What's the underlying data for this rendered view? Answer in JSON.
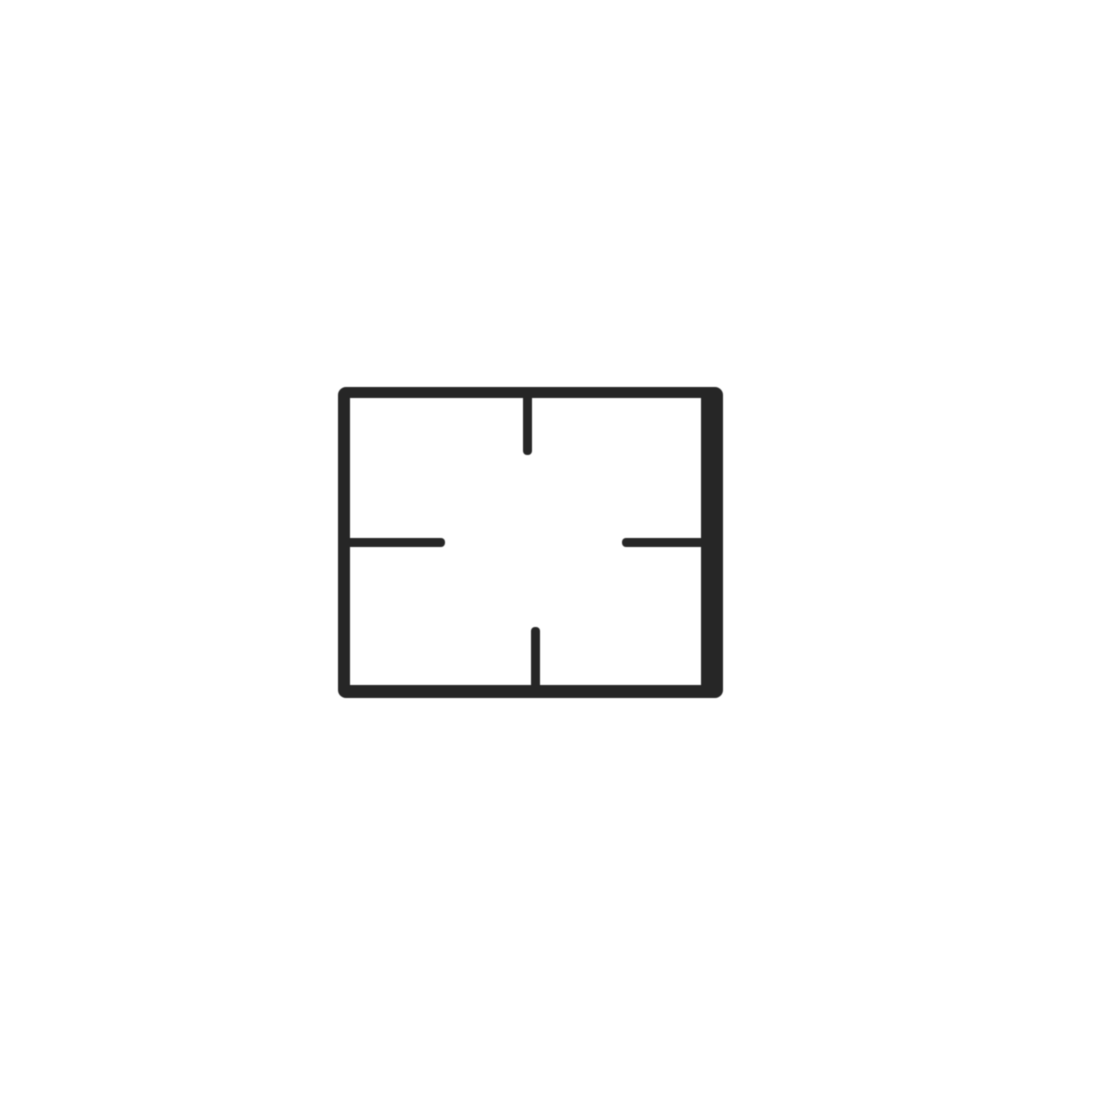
{
  "meta": {
    "description": "Black cast-iron style rectangular gas-hob pan support grid photographed from above on a plain white background",
    "background_color": "#ffffff"
  },
  "grid": {
    "color": "#262626",
    "corner_radius": 8,
    "frame": {
      "left": 338,
      "top": 387,
      "width": 385,
      "height": 311,
      "border_top": 11,
      "border_right": 22,
      "border_bottom": 13,
      "border_left": 12
    },
    "prongs": [
      {
        "name": "top-prong",
        "left": 523,
        "top": 398,
        "width": 9,
        "height": 57,
        "rounded": "bottom"
      },
      {
        "name": "bottom-prong",
        "left": 531,
        "top": 627,
        "width": 9,
        "height": 58,
        "rounded": "top"
      },
      {
        "name": "left-prong",
        "left": 350,
        "top": 538,
        "width": 95,
        "height": 9,
        "rounded": "right"
      },
      {
        "name": "right-prong",
        "left": 622,
        "top": 538,
        "width": 79,
        "height": 9,
        "rounded": "left"
      }
    ]
  }
}
